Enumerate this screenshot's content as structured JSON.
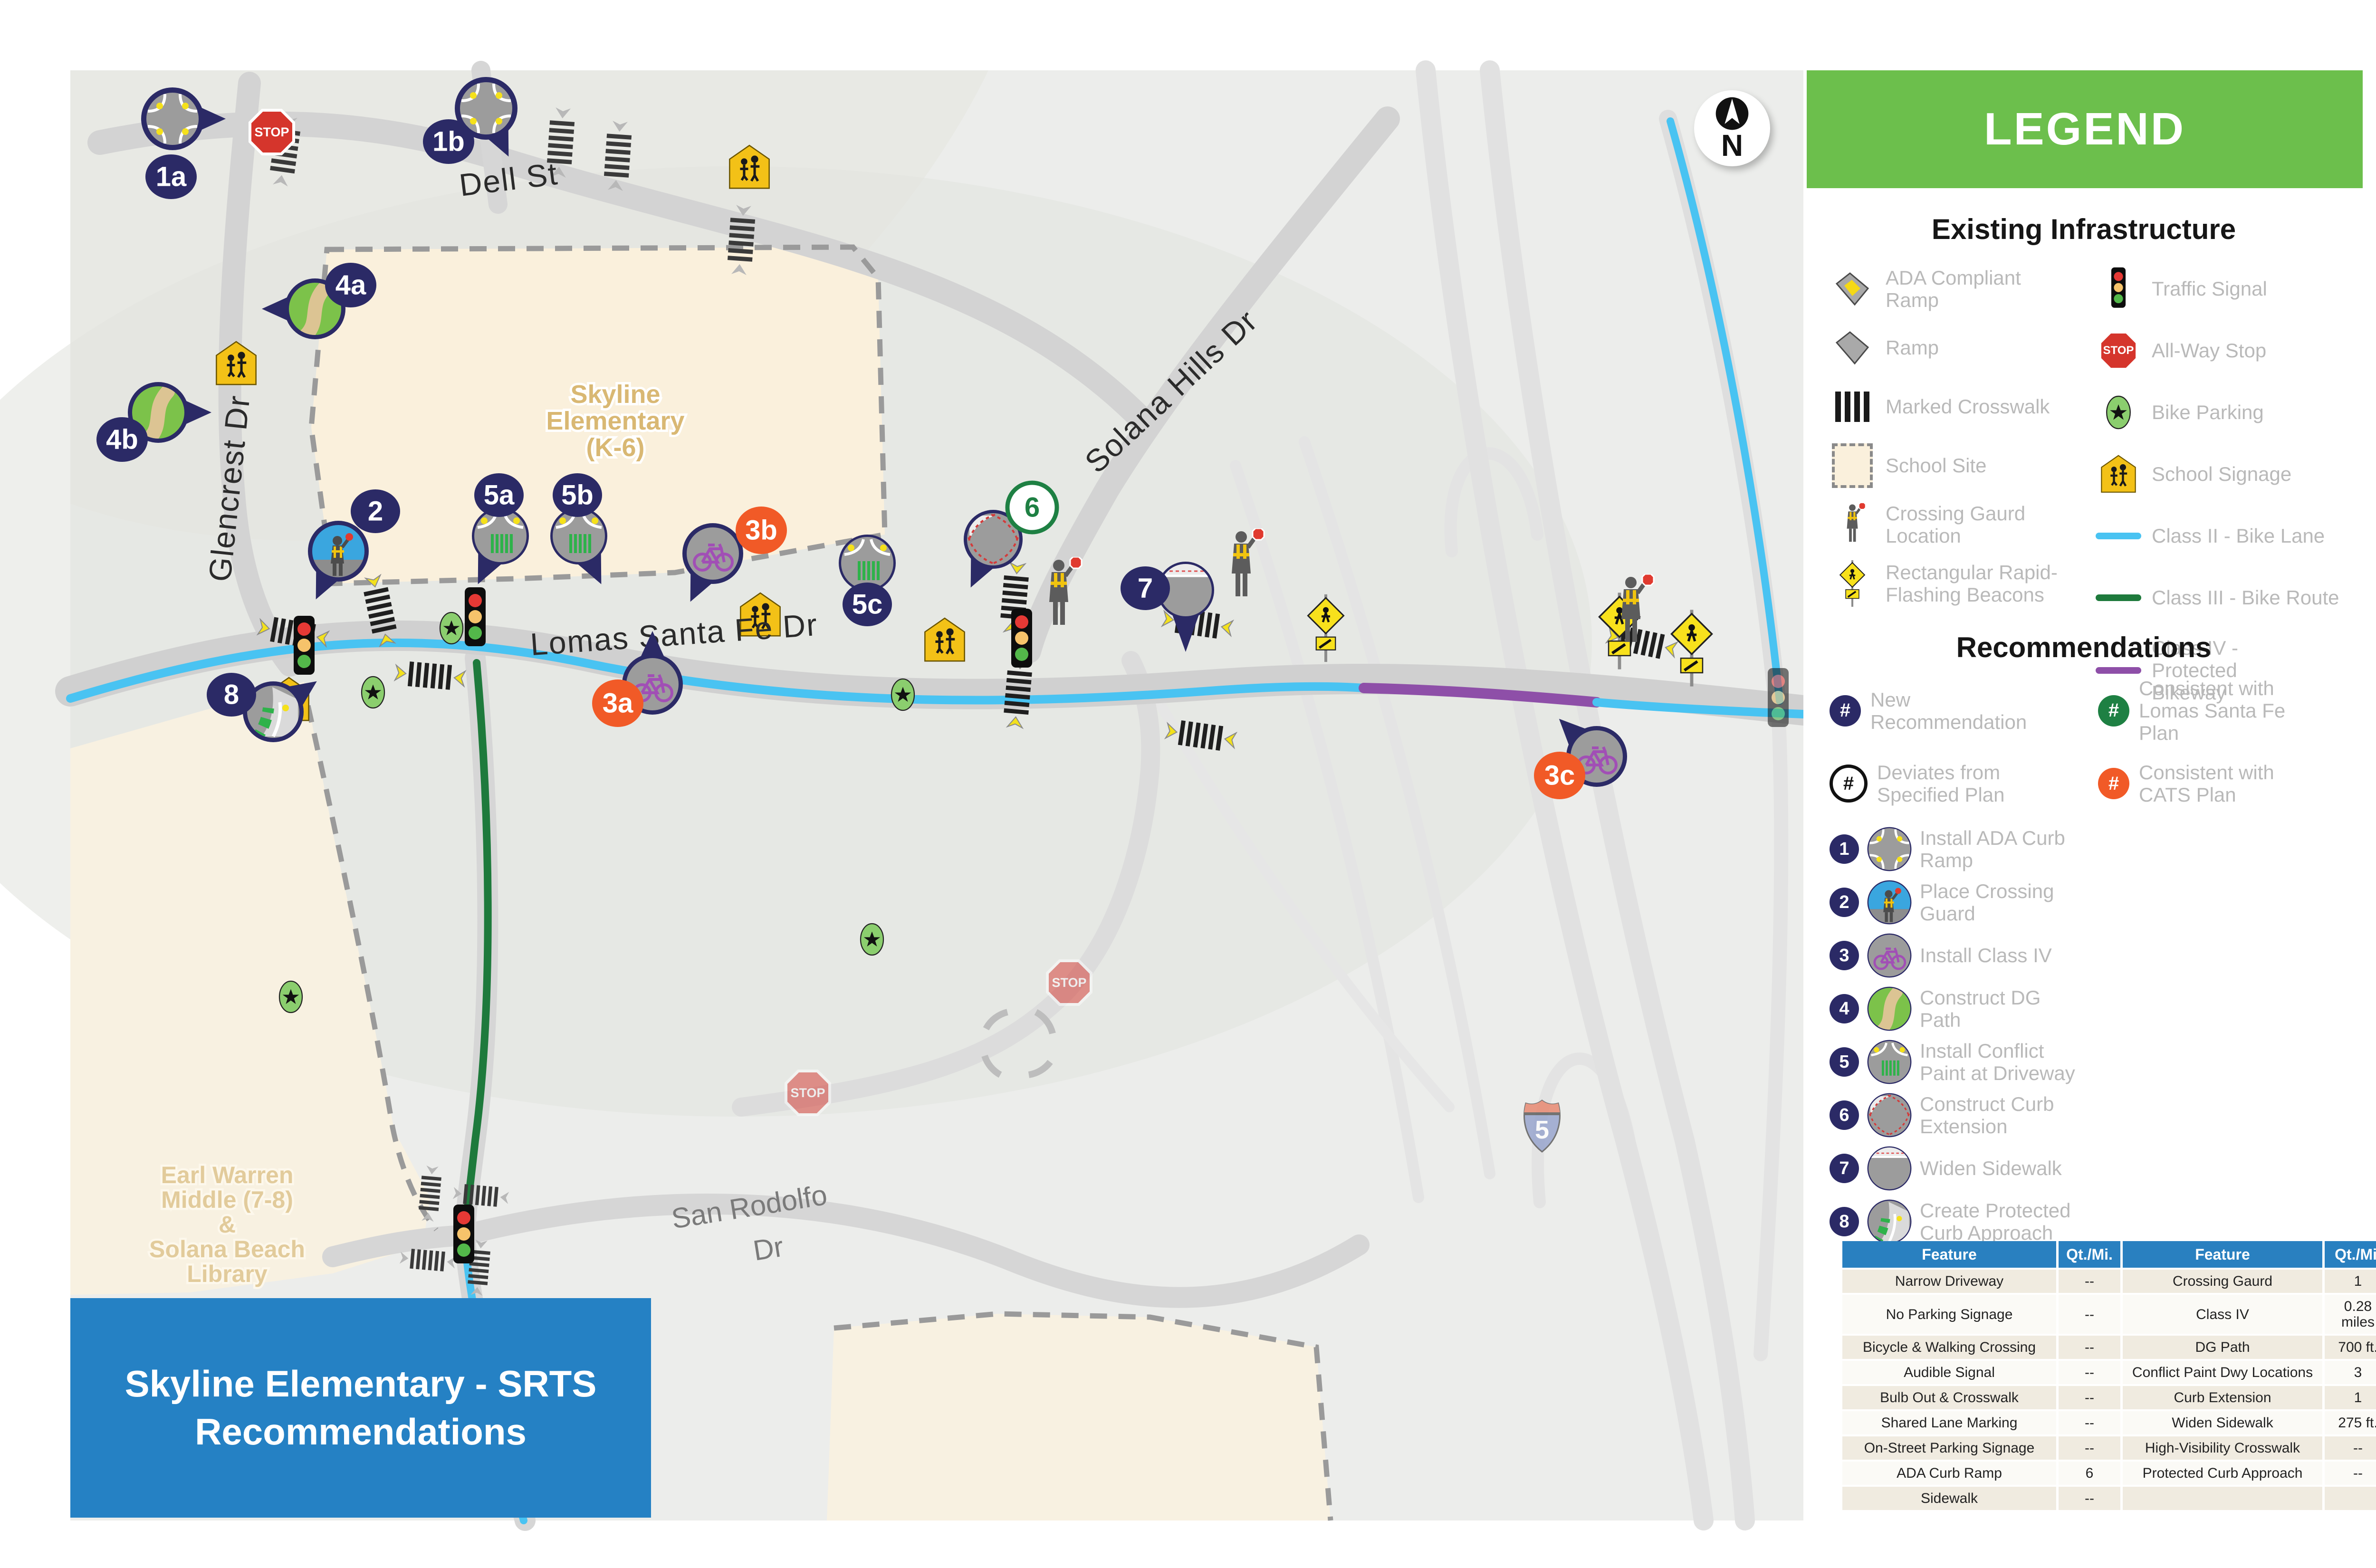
{
  "title_box": {
    "text": "Skyline Elementary - SRTS\nRecommendations"
  },
  "compass": {
    "label": "N"
  },
  "legend": {
    "title": "LEGEND",
    "existing": {
      "title": "Existing Infrastructure",
      "left": [
        {
          "icon": "ada-compliant-ramp",
          "label": "ADA Compliant Ramp"
        },
        {
          "icon": "ramp",
          "label": "Ramp"
        },
        {
          "icon": "marked-crosswalk",
          "label": "Marked Crosswalk"
        },
        {
          "icon": "school-site",
          "label": "School Site"
        },
        {
          "icon": "crossing-guard-location",
          "label": "Crossing Gaurd Location"
        },
        {
          "icon": "rrfb",
          "label": "Rectangular Rapid-Flashing Beacons"
        }
      ],
      "right": [
        {
          "icon": "traffic-signal",
          "label": "Traffic Signal"
        },
        {
          "icon": "all-way-stop",
          "label": "All-Way Stop"
        },
        {
          "icon": "bike-parking",
          "label": "Bike Parking"
        },
        {
          "icon": "school-signage",
          "label": "School Signage"
        },
        {
          "icon": "class-2-bike-lane",
          "label": "Class II - Bike Lane"
        },
        {
          "icon": "class-3-bike-route",
          "label": "Class III - Bike Route"
        },
        {
          "icon": "class-4-protected-bikeway",
          "label": "Class IV - Protected Bikeway"
        }
      ]
    },
    "recommendations": {
      "title": "Recommendations",
      "keys": [
        {
          "style": "navy",
          "symbol": "#",
          "label": "New Recommendation"
        },
        {
          "style": "green",
          "symbol": "#",
          "label": "Consistent with Lomas Santa Fe Plan"
        },
        {
          "style": "outline",
          "symbol": "#",
          "label": "Deviates from Specified Plan"
        },
        {
          "style": "orange",
          "symbol": "#",
          "label": "Consistent with CATS Plan"
        }
      ],
      "items": [
        {
          "num": "1",
          "label": "Install ADA Curb Ramp"
        },
        {
          "num": "2",
          "label": "Place Crossing Guard"
        },
        {
          "num": "3",
          "label": "Install Class IV"
        },
        {
          "num": "4",
          "label": "Construct DG Path"
        },
        {
          "num": "5",
          "label": "Install Conflict Paint at Driveway"
        },
        {
          "num": "6",
          "label": "Construct Curb Extension"
        },
        {
          "num": "7",
          "label": "Widen Sidewalk"
        },
        {
          "num": "8",
          "label": "Create Protected Curb Approach"
        }
      ]
    }
  },
  "summary_table": {
    "headers": [
      "Feature",
      "Qt./Mi.",
      "Feature",
      "Qt./Mi."
    ],
    "rows": [
      [
        "Narrow Driveway",
        "--",
        "Crossing Gaurd",
        "1"
      ],
      [
        "No Parking Signage",
        "--",
        "Class IV",
        "0.28 miles"
      ],
      [
        "Bicycle & Walking Crossing",
        "--",
        "DG Path",
        "700 ft."
      ],
      [
        "Audible Signal",
        "--",
        "Conflict Paint Dwy Locations",
        "3"
      ],
      [
        "Bulb Out & Crosswalk",
        "--",
        "Curb Extension",
        "1"
      ],
      [
        "Shared Lane Marking",
        "--",
        "Widen Sidewalk",
        "275 ft."
      ],
      [
        "On-Street Parking Signage",
        "--",
        "High-Visibility Crosswalk",
        "--"
      ],
      [
        "ADA Curb Ramp",
        "6",
        "Protected Curb Approach",
        "--"
      ],
      [
        "Sidewalk",
        "--",
        "",
        ""
      ]
    ]
  },
  "map": {
    "stop_label": "STOP",
    "shield_label": "5",
    "streets": {
      "dell": "Dell St",
      "glencrest": "Glencrest Dr",
      "lomas": "Lomas Santa Fe Dr",
      "solana_hills": "Solana Hills Dr",
      "san_rodolfo_1": "San Rodolfo",
      "san_rodolfo_2": "Dr",
      "partial_street": "Ste"
    },
    "areas": {
      "skyline_1": "Skyline",
      "skyline_2": "Elementary",
      "skyline_3": "(K-6)",
      "earl_1": "Earl Warren",
      "earl_2": "Middle (7-8)",
      "earl_3": "&",
      "earl_4": "Solana Beach",
      "earl_5": "Library"
    },
    "markers": [
      {
        "label": "1a",
        "plan": "new"
      },
      {
        "label": "1b",
        "plan": "new"
      },
      {
        "label": "2",
        "plan": "new"
      },
      {
        "label": "3a",
        "plan": "cats"
      },
      {
        "label": "3b",
        "plan": "cats"
      },
      {
        "label": "3c",
        "plan": "cats"
      },
      {
        "label": "4a",
        "plan": "new"
      },
      {
        "label": "4b",
        "plan": "new"
      },
      {
        "label": "5a",
        "plan": "new"
      },
      {
        "label": "5b",
        "plan": "new"
      },
      {
        "label": "5c",
        "plan": "new"
      },
      {
        "label": "6",
        "plan": "lomas"
      },
      {
        "label": "7",
        "plan": "new"
      },
      {
        "label": "8",
        "plan": "new"
      }
    ]
  }
}
